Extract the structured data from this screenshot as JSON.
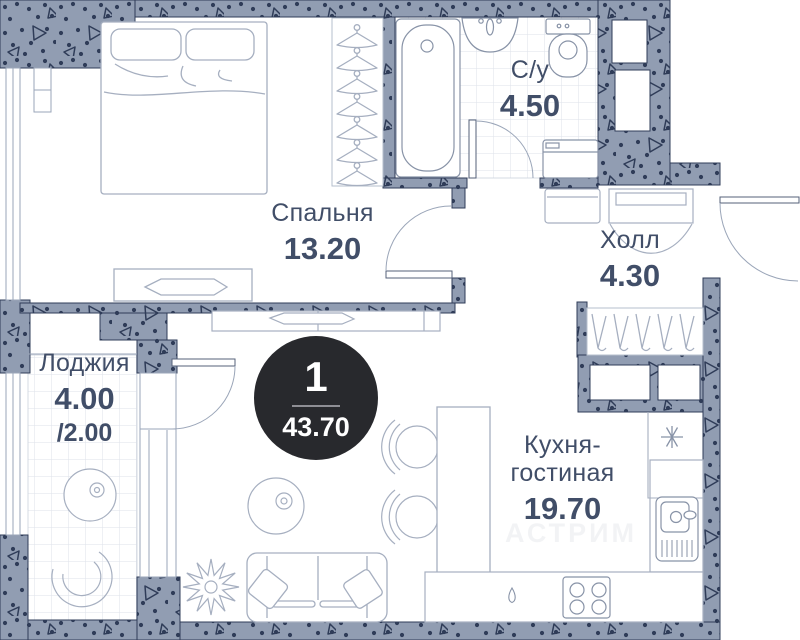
{
  "badge": {
    "rooms_count": "1",
    "total_area": "43.70"
  },
  "rooms": {
    "bedroom": {
      "name": "Спальня",
      "area": "13.20"
    },
    "bathroom": {
      "name": "С/у",
      "area": "4.50"
    },
    "hall": {
      "name": "Холл",
      "area": "4.30"
    },
    "loggia": {
      "name": "Лоджия",
      "area": "4.00",
      "area_secondary": "/2.00"
    },
    "kitchen": {
      "name_line1": "Кухня-",
      "name_line2": "гостиная",
      "area": "19.70"
    }
  },
  "watermark": "АСТРИМ",
  "icons": {
    "vent": "asterisk"
  },
  "colors": {
    "wall_fill": "#919db2",
    "wall_accent": "#2f3c58",
    "text_primary": "#414e68",
    "badge_background": "#28292d",
    "badge_text": "#ffffff",
    "furniture_stroke": "#a6afc0",
    "fixture_stroke": "#8893a7",
    "tile_line": "#dde2ea"
  }
}
